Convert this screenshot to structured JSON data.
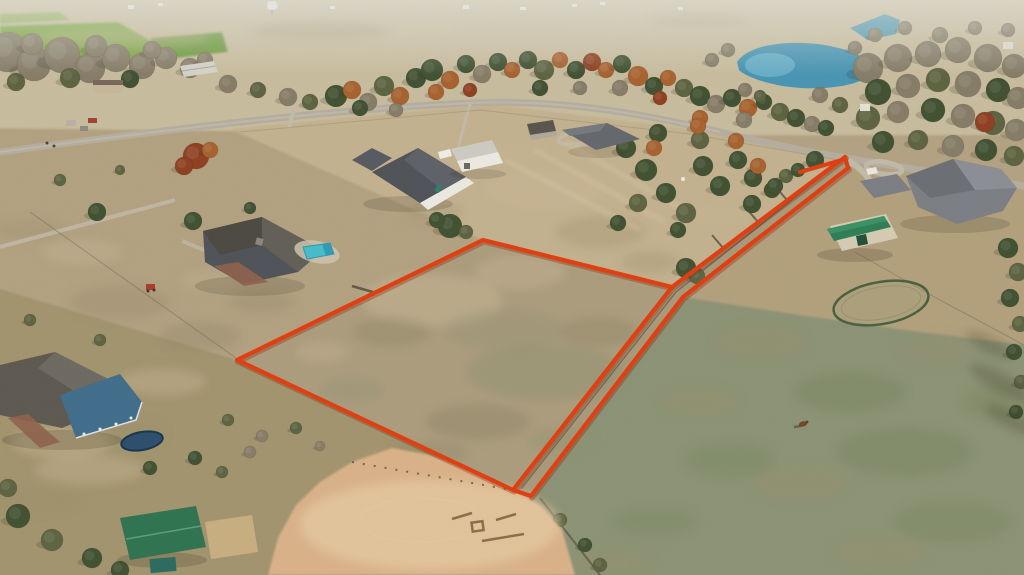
{
  "meta": {
    "kind": "aerial-drone-photograph",
    "subject": "rural acreage real-estate listing photo with property boundary outlined in red",
    "width": 1024,
    "height": 575
  },
  "colors": {
    "boundary_red": "#e23c0e",
    "boundary_shadow": "#8a2408",
    "road_gray": "#b6ae9f",
    "driveway_gray": "#c3bbab",
    "pond_blue": "#4795b4",
    "pond_light": "#7cc0d6",
    "pool_blue": "#45bdca",
    "arena_sand": "#dab289",
    "arena_light": "#ecd2a8",
    "field_green": "#7aa640",
    "field_green2": "#6d9a3c",
    "pasture_green": "#8c9374",
    "parcel_tan": "#ac9d7d",
    "lane_tan": "#a89a7a",
    "ne_tan": "#c4b28f",
    "west_tan": "#b3a281",
    "sw_tan": "#a2946e",
    "yard_tan": "#b3a17d",
    "distant_tan": "#c9bd9f",
    "roof_dark": "#4e5157",
    "roof_mid": "#63666c",
    "roof_light": "#7b7e84",
    "roof_green": "#2c7e55",
    "porch_blue": "#3f6d8b",
    "barn_white": "#ecebe3",
    "shed_green": "#2e7350",
    "trampoline_navy": "#2b4e6c",
    "brick": "#8f614b",
    "horse_brown": "#6f4526"
  },
  "boundary": {
    "stroke_width": 4.2,
    "field_polygon": "483,240 672,287 513,490 237,360",
    "lane_upper": "672,287 845,157",
    "lane_lower": "848,168 683,297 531,496",
    "lane_tip": "845,157 848,168",
    "lane_tick": "800,172 842,160",
    "south_closure": "513,490 531,496"
  },
  "palette": {
    "g": "#3f5030",
    "e": "#5c6340",
    "o": "#a8612d",
    "r": "#8f3f1f",
    "b": "#867c67",
    "lt": "#cab795",
    "dk": "#8b8165",
    "gn": "#8d9170",
    "pg": "#75835d",
    "br": "#9c8d6b",
    "shadow": "#35301f"
  },
  "trees": [
    [
      8,
      52,
      20,
      "b"
    ],
    [
      34,
      64,
      17,
      "b"
    ],
    [
      62,
      55,
      18,
      "b"
    ],
    [
      90,
      68,
      15,
      "b"
    ],
    [
      116,
      58,
      14,
      "b"
    ],
    [
      142,
      66,
      13,
      "b"
    ],
    [
      96,
      46,
      11,
      "b"
    ],
    [
      32,
      44,
      11,
      "b"
    ],
    [
      166,
      58,
      11,
      "b"
    ],
    [
      190,
      68,
      10,
      "b"
    ],
    [
      70,
      78,
      10,
      "e"
    ],
    [
      130,
      79,
      9,
      "g"
    ],
    [
      16,
      82,
      9,
      "e"
    ],
    [
      152,
      50,
      9,
      "b"
    ],
    [
      205,
      60,
      8,
      "b"
    ],
    [
      228,
      84,
      9,
      "b"
    ],
    [
      258,
      90,
      8,
      "e"
    ],
    [
      288,
      97,
      9,
      "b"
    ],
    [
      310,
      102,
      8,
      "e"
    ],
    [
      97,
      212,
      9,
      "g"
    ],
    [
      193,
      221,
      9,
      "g"
    ],
    [
      250,
      208,
      6,
      "g"
    ],
    [
      60,
      180,
      6,
      "e"
    ],
    [
      120,
      170,
      5,
      "e"
    ],
    [
      196,
      156,
      13,
      "r"
    ],
    [
      184,
      166,
      9,
      "r"
    ],
    [
      210,
      150,
      8,
      "o"
    ],
    [
      336,
      96,
      11,
      "g"
    ],
    [
      352,
      90,
      9,
      "o"
    ],
    [
      368,
      102,
      9,
      "b"
    ],
    [
      384,
      86,
      10,
      "e"
    ],
    [
      400,
      96,
      9,
      "o"
    ],
    [
      416,
      78,
      10,
      "g"
    ],
    [
      432,
      70,
      11,
      "g"
    ],
    [
      450,
      80,
      9,
      "o"
    ],
    [
      466,
      64,
      9,
      "g"
    ],
    [
      482,
      74,
      9,
      "b"
    ],
    [
      498,
      62,
      9,
      "g"
    ],
    [
      512,
      70,
      8,
      "o"
    ],
    [
      528,
      60,
      9,
      "g"
    ],
    [
      544,
      70,
      10,
      "e"
    ],
    [
      560,
      60,
      8,
      "o"
    ],
    [
      576,
      70,
      9,
      "g"
    ],
    [
      592,
      62,
      9,
      "r"
    ],
    [
      606,
      70,
      8,
      "o"
    ],
    [
      622,
      64,
      9,
      "g"
    ],
    [
      638,
      76,
      10,
      "o"
    ],
    [
      654,
      86,
      9,
      "g"
    ],
    [
      668,
      78,
      8,
      "o"
    ],
    [
      684,
      88,
      9,
      "e"
    ],
    [
      700,
      96,
      10,
      "g"
    ],
    [
      716,
      104,
      9,
      "b"
    ],
    [
      732,
      98,
      9,
      "g"
    ],
    [
      748,
      108,
      9,
      "o"
    ],
    [
      764,
      102,
      8,
      "g"
    ],
    [
      780,
      112,
      9,
      "e"
    ],
    [
      796,
      118,
      9,
      "g"
    ],
    [
      812,
      124,
      8,
      "b"
    ],
    [
      826,
      128,
      8,
      "g"
    ],
    [
      436,
      92,
      8,
      "o"
    ],
    [
      470,
      90,
      7,
      "r"
    ],
    [
      540,
      88,
      8,
      "g"
    ],
    [
      580,
      88,
      7,
      "b"
    ],
    [
      620,
      88,
      8,
      "b"
    ],
    [
      660,
      98,
      7,
      "r"
    ],
    [
      700,
      118,
      8,
      "o"
    ],
    [
      744,
      120,
      8,
      "b"
    ],
    [
      360,
      108,
      8,
      "g"
    ],
    [
      396,
      110,
      7,
      "b"
    ],
    [
      868,
      68,
      15,
      "b"
    ],
    [
      898,
      58,
      14,
      "b"
    ],
    [
      928,
      54,
      13,
      "b"
    ],
    [
      958,
      50,
      13,
      "b"
    ],
    [
      988,
      58,
      14,
      "b"
    ],
    [
      1014,
      66,
      12,
      "b"
    ],
    [
      878,
      92,
      13,
      "g"
    ],
    [
      908,
      86,
      12,
      "b"
    ],
    [
      938,
      80,
      12,
      "e"
    ],
    [
      968,
      84,
      13,
      "b"
    ],
    [
      998,
      90,
      12,
      "g"
    ],
    [
      1018,
      98,
      11,
      "b"
    ],
    [
      868,
      118,
      12,
      "e"
    ],
    [
      898,
      112,
      11,
      "b"
    ],
    [
      933,
      110,
      12,
      "g"
    ],
    [
      963,
      116,
      12,
      "b"
    ],
    [
      993,
      123,
      12,
      "e"
    ],
    [
      1016,
      130,
      11,
      "b"
    ],
    [
      883,
      142,
      11,
      "g"
    ],
    [
      918,
      140,
      10,
      "e"
    ],
    [
      953,
      146,
      11,
      "b"
    ],
    [
      986,
      150,
      11,
      "g"
    ],
    [
      1014,
      156,
      10,
      "e"
    ],
    [
      985,
      122,
      10,
      "r"
    ],
    [
      940,
      35,
      8,
      "b"
    ],
    [
      975,
      28,
      7,
      "b"
    ],
    [
      1008,
      30,
      7,
      "b"
    ],
    [
      905,
      28,
      7,
      "b"
    ],
    [
      875,
      35,
      7,
      "b"
    ],
    [
      626,
      148,
      10,
      "g"
    ],
    [
      646,
      170,
      11,
      "g"
    ],
    [
      666,
      193,
      10,
      "g"
    ],
    [
      686,
      213,
      10,
      "e"
    ],
    [
      703,
      166,
      10,
      "g"
    ],
    [
      720,
      186,
      10,
      "g"
    ],
    [
      738,
      160,
      9,
      "g"
    ],
    [
      700,
      140,
      9,
      "e"
    ],
    [
      658,
      133,
      9,
      "g"
    ],
    [
      753,
      178,
      9,
      "g"
    ],
    [
      638,
      203,
      9,
      "e"
    ],
    [
      618,
      223,
      8,
      "g"
    ],
    [
      678,
      230,
      8,
      "g"
    ],
    [
      654,
      148,
      8,
      "o"
    ],
    [
      698,
      126,
      8,
      "o"
    ],
    [
      736,
      141,
      8,
      "o"
    ],
    [
      758,
      166,
      8,
      "o"
    ],
    [
      772,
      190,
      8,
      "g"
    ],
    [
      786,
      176,
      7,
      "e"
    ],
    [
      815,
      160,
      9,
      "g"
    ],
    [
      798,
      170,
      7,
      "g"
    ],
    [
      775,
      186,
      8,
      "g"
    ],
    [
      752,
      204,
      9,
      "g"
    ],
    [
      686,
      268,
      10,
      "g"
    ],
    [
      697,
      276,
      8,
      "e"
    ],
    [
      450,
      226,
      12,
      "g"
    ],
    [
      437,
      220,
      8,
      "g"
    ],
    [
      466,
      232,
      7,
      "e"
    ],
    [
      1008,
      248,
      10,
      "g"
    ],
    [
      1018,
      272,
      9,
      "e"
    ],
    [
      1010,
      298,
      9,
      "g"
    ],
    [
      1020,
      324,
      8,
      "e"
    ],
    [
      1014,
      352,
      8,
      "g"
    ],
    [
      1021,
      382,
      7,
      "e"
    ],
    [
      1016,
      412,
      7,
      "g"
    ],
    [
      18,
      516,
      12,
      "g"
    ],
    [
      52,
      540,
      11,
      "e"
    ],
    [
      92,
      558,
      10,
      "g"
    ],
    [
      8,
      488,
      9,
      "e"
    ],
    [
      120,
      570,
      9,
      "g"
    ],
    [
      228,
      420,
      6,
      "e"
    ],
    [
      262,
      436,
      6,
      "b"
    ],
    [
      296,
      428,
      6,
      "e"
    ],
    [
      320,
      446,
      5,
      "b"
    ],
    [
      250,
      452,
      6,
      "b"
    ],
    [
      195,
      458,
      7,
      "g"
    ],
    [
      222,
      472,
      6,
      "e"
    ],
    [
      60,
      390,
      7,
      "e"
    ],
    [
      100,
      340,
      6,
      "e"
    ],
    [
      30,
      320,
      6,
      "e"
    ],
    [
      150,
      468,
      7,
      "g"
    ],
    [
      560,
      520,
      7,
      "e"
    ],
    [
      585,
      545,
      7,
      "g"
    ],
    [
      600,
      565,
      7,
      "e"
    ],
    [
      728,
      50,
      7,
      "b"
    ],
    [
      712,
      60,
      7,
      "b"
    ],
    [
      745,
      90,
      7,
      "b"
    ],
    [
      760,
      96,
      6,
      "e"
    ],
    [
      820,
      95,
      8,
      "b"
    ],
    [
      840,
      105,
      8,
      "e"
    ],
    [
      855,
      48,
      7,
      "b"
    ]
  ],
  "mottles": [
    [
      120,
      38,
      90,
      10,
      "lt",
      0.35
    ],
    [
      320,
      30,
      70,
      8,
      "br",
      0.3
    ],
    [
      520,
      24,
      60,
      7,
      "lt",
      0.3
    ],
    [
      950,
      38,
      48,
      8,
      "lt",
      0.35
    ],
    [
      700,
      20,
      50,
      6,
      "br",
      0.25
    ],
    [
      545,
      190,
      60,
      20,
      "lt",
      0.4
    ],
    [
      600,
      232,
      45,
      16,
      "br",
      0.3
    ],
    [
      650,
      262,
      28,
      11,
      "br",
      0.3
    ],
    [
      505,
      152,
      40,
      12,
      "lt",
      0.3
    ],
    [
      435,
      212,
      28,
      10,
      "br",
      0.25
    ],
    [
      715,
      215,
      30,
      12,
      "lt",
      0.3
    ],
    [
      432,
      300,
      70,
      26,
      "lt",
      0.5
    ],
    [
      520,
      272,
      45,
      17,
      "lt",
      0.4
    ],
    [
      545,
      372,
      78,
      28,
      "gn",
      0.45
    ],
    [
      478,
      422,
      52,
      18,
      "dk",
      0.4
    ],
    [
      392,
      332,
      38,
      15,
      "dk",
      0.35
    ],
    [
      352,
      390,
      33,
      13,
      "gn",
      0.3
    ],
    [
      598,
      332,
      38,
      15,
      "dk",
      0.35
    ],
    [
      432,
      452,
      38,
      11,
      "dk",
      0.3
    ],
    [
      560,
      440,
      33,
      11,
      "gn",
      0.35
    ],
    [
      322,
      352,
      26,
      11,
      "lt",
      0.35
    ],
    [
      505,
      330,
      60,
      22,
      "gn",
      0.3
    ],
    [
      760,
      342,
      45,
      16,
      "br",
      0.3
    ],
    [
      850,
      392,
      55,
      20,
      "pg",
      0.4
    ],
    [
      905,
      452,
      68,
      24,
      "pg",
      0.4
    ],
    [
      800,
      482,
      48,
      17,
      "br",
      0.3
    ],
    [
      952,
      522,
      58,
      20,
      "pg",
      0.35
    ],
    [
      700,
      402,
      38,
      14,
      "br",
      0.3
    ],
    [
      880,
      552,
      48,
      14,
      "br",
      0.3
    ],
    [
      1000,
      402,
      38,
      17,
      "pg",
      0.35
    ],
    [
      655,
      522,
      42,
      14,
      "pg",
      0.3
    ],
    [
      612,
      562,
      38,
      11,
      "br",
      0.3
    ],
    [
      730,
      460,
      45,
      18,
      "pg",
      0.3
    ],
    [
      940,
      350,
      40,
      15,
      "br",
      0.25
    ],
    [
      120,
      302,
      50,
      17,
      "br",
      0.35
    ],
    [
      200,
      336,
      40,
      14,
      "dk",
      0.3
    ],
    [
      82,
      252,
      40,
      13,
      "lt",
      0.35
    ],
    [
      162,
      382,
      44,
      14,
      "lt",
      0.4
    ],
    [
      262,
      302,
      33,
      11,
      "dk",
      0.25
    ],
    [
      62,
      442,
      50,
      17,
      "lt",
      0.45
    ],
    [
      132,
      432,
      33,
      11,
      "br",
      0.3
    ],
    [
      30,
      230,
      35,
      10,
      "br",
      0.3
    ],
    [
      210,
      280,
      30,
      10,
      "lt",
      0.3
    ],
    [
      90,
      470,
      55,
      15,
      "lt",
      0.4
    ],
    [
      40,
      500,
      40,
      12,
      "br",
      0.3
    ]
  ],
  "scene_features": [
    "outlined vacant land parcel",
    "fenced access lane to road",
    "paved country road",
    "sand riding arena",
    "round pen",
    "swimming pool",
    "trampoline",
    "pond",
    "green-roof barn",
    "white metal barn",
    "single horse in pasture",
    "water tower on horizon"
  ]
}
